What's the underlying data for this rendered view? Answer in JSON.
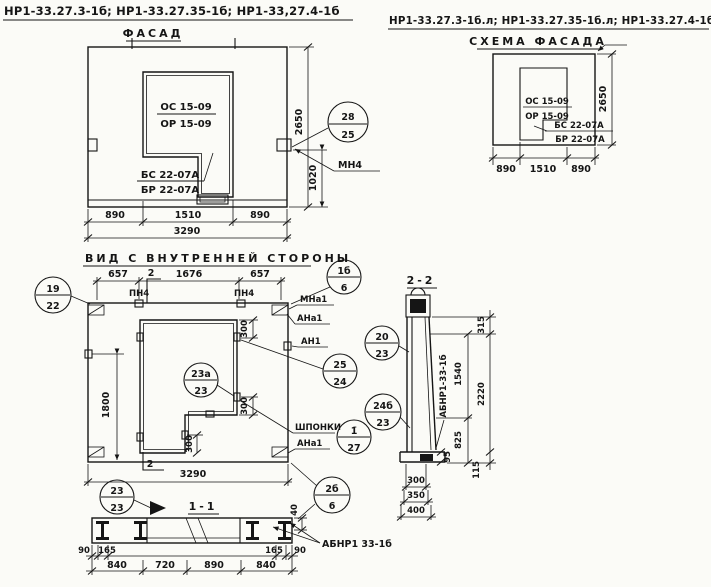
{
  "titles": {
    "doc_left": "НР1-33.27.3-1б; НР1-33.27.35-1б; НР1-33,27.4-1б",
    "facade": "ФАСАД",
    "doc_right": "НР1-33.27.3-1б.л; НР1-33.27.35-1б.л; НР1-33.27.4-1б.л",
    "schema": "СХЕМА ФАСАДА",
    "internal": "ВИД С ВНУТРЕННЕЙ СТОРОНЫ",
    "section22": "2-2",
    "section11": "1-1"
  },
  "facade": {
    "window_mark": {
      "top": "ОС 15-09",
      "bottom": "ОР 15-09"
    },
    "sill_mark": {
      "top": "БС 22-07А",
      "bottom": "БР 22-07А"
    },
    "dims": [
      "890",
      "1510",
      "890"
    ],
    "dim_total": "3290",
    "dim_height": "2650",
    "dim_lower": "1020",
    "callout": {
      "num": "28",
      "sheet": "25"
    },
    "anchor": "МН4"
  },
  "schema": {
    "window_mark": {
      "top": "ОС 15-09",
      "bottom": "ОР 15-09"
    },
    "sill_mark": {
      "top": "БС 22-07А",
      "bottom": "БР 22-07А"
    },
    "dims": [
      "890",
      "1510",
      "890"
    ],
    "dim_height": "2650"
  },
  "internal": {
    "dim_top": [
      "657",
      "1676",
      "657"
    ],
    "anchor_top": "ПН4",
    "section_no": "2",
    "dim_1800": "1800",
    "dim_300": "300",
    "dim_total": "3290",
    "labels": {
      "mna1": "МНа1",
      "ana1": "АНа1",
      "an1": "АН1",
      "keys": "ШПОНКИ"
    },
    "callouts": {
      "left": {
        "num": "19",
        "sheet": "22"
      },
      "top_right": {
        "num": "1б",
        "sheet": "6"
      },
      "window": {
        "num": "23а",
        "sheet": "23"
      },
      "mid_right": {
        "num": "25",
        "sheet": "24"
      },
      "keys": {
        "num": "1̄",
        "sheet": "27"
      },
      "sec22_top": {
        "num": "20",
        "sheet": "23"
      },
      "sec22_bot": {
        "num": "24б",
        "sheet": "23"
      },
      "bottom_right": {
        "num": "2б",
        "sheet": "6"
      }
    }
  },
  "section22": {
    "dim_315": "315",
    "dim_1540": "1540",
    "dim_825": "825",
    "dim_2220": "2220",
    "dim_115": "115",
    "dim_95": "95",
    "dim_300": "300",
    "dim_350": "350",
    "dim_400": "400",
    "mark": "АБНР1-33-1б"
  },
  "section11": {
    "dim_40": "40",
    "mark": "АБНР1 33-1б",
    "row1": [
      "90",
      "165",
      "165",
      "90"
    ],
    "row2": [
      "840",
      "720",
      "890",
      "840"
    ],
    "callout": {
      "num": "23",
      "sheet": "23"
    }
  }
}
